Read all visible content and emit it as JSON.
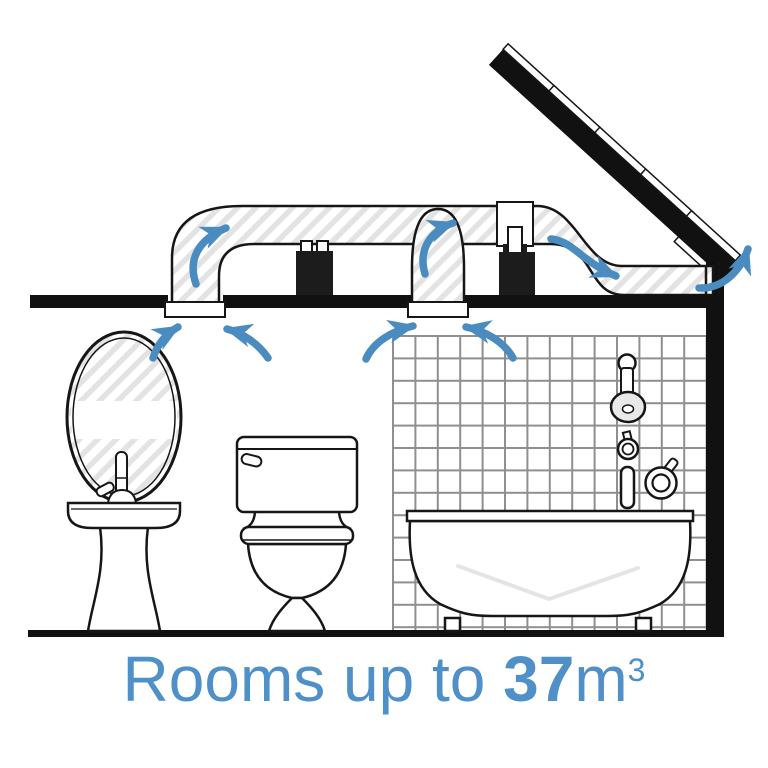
{
  "caption": {
    "prefix": "Rooms up to ",
    "volume": "37",
    "unit": "m",
    "exponent": "3"
  },
  "colors": {
    "accent_blue": "#4e90c7",
    "arrow_blue": "#4a8cc0",
    "line_black": "#161616",
    "hatch_gray": "#e3e3e3",
    "tile_grid_gray": "#8f8f8f"
  },
  "scene": {
    "parts": [
      "pitched-roof-icon",
      "exhaust-duct-icon",
      "wall-exit-grille-icon",
      "inline-fan-icon",
      "inline-fan-icon",
      "ceiling-vent-icon",
      "ceiling-vent-icon",
      "airflow-arrow-icon",
      "mirror-icon",
      "pedestal-sink-icon",
      "toilet-icon",
      "bathtub-icon",
      "shower-set-icon",
      "tiled-wall"
    ]
  }
}
